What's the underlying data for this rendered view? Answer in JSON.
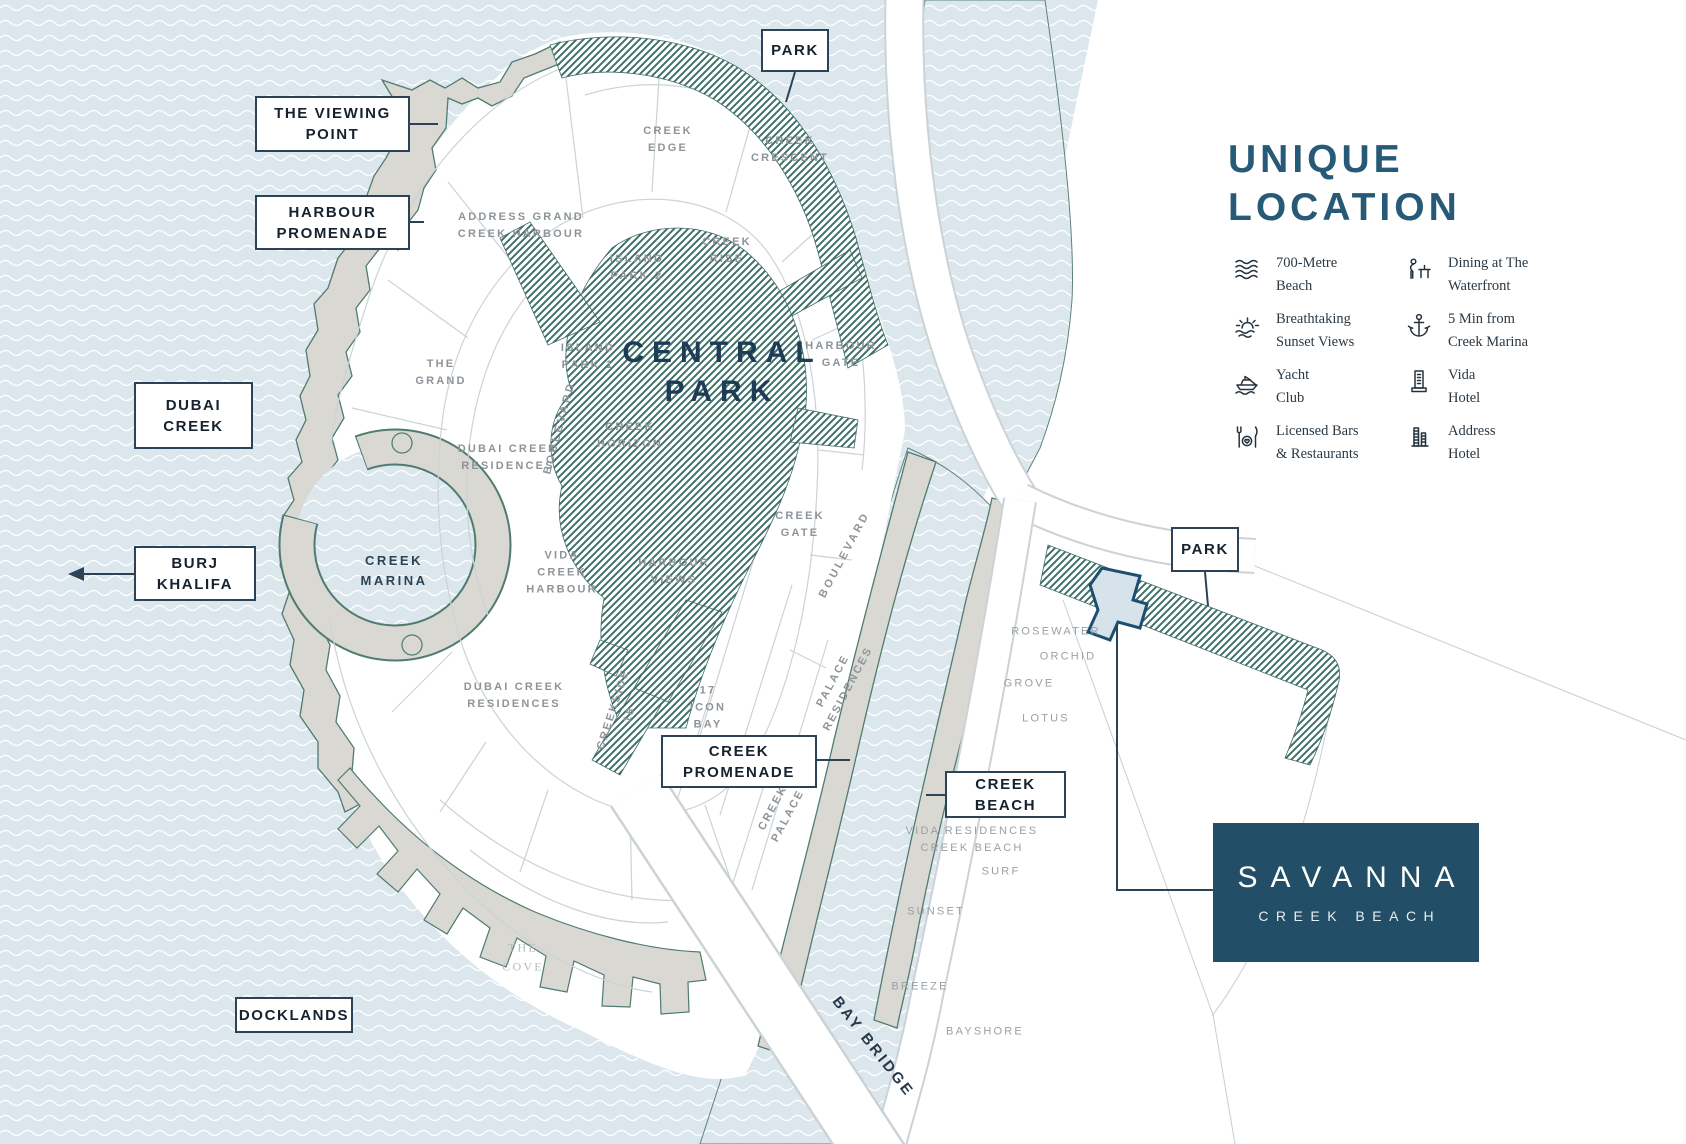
{
  "callouts": {
    "park_top": "PARK",
    "viewing_point": "THE VIEWING\nPOINT",
    "harbour_promenade": "HARBOUR\nPROMENADE",
    "dubai_creek": "DUBAI\nCREEK",
    "burj_khalifa": "BURJ\nKHALIFA",
    "docklands": "DOCKLANDS",
    "creek_promenade": "CREEK\nPROMENADE",
    "creek_beach": "CREEK\nBEACH",
    "park_right": "PARK"
  },
  "areas": {
    "central_park": "CENTRAL\nPARK",
    "creek_edge": "CREEK\nEDGE",
    "creek_crescent": "CREEK\nCRESCENT",
    "creek_rise": "CREEK\nRISE",
    "island_park_2": "ISLAND\nPARK 2",
    "island_park_1": "ISLAND\nPARK 1",
    "harbour_gate": "HARBOUR\nGATE",
    "the_grand": "THE\nGRAND",
    "address_grand_creek_harbour": "ADDRESS GRAND\nCREEK HARBOUR",
    "dubai_creek_residences_upper": "DUBAI CREEK\nRESIDENCES",
    "dubai_creek_residences_lower": "DUBAI CREEK\nRESIDENCES",
    "boulevard_left": "BOULEVARD",
    "boulevard_right": "BOULEVARD",
    "creek_horizon": "CREEK\nHORIZON",
    "vida_creek_harbour": "VIDA\nCREEK\nHARBOUR",
    "creek_marina": "CREEK\nMARINA",
    "harbour_views": "HARBOUR\nVIEWS",
    "creek_gate": "CREEK\nGATE",
    "creekside_18": "CREEKSIDE\n18",
    "icon_bay_17": "17\nICON\nBAY",
    "palace_residences": "PALACE\nRESIDENCES",
    "creek_palace": "CREEK\nPALACE",
    "rosewater": "ROSEWATER",
    "orchid": "ORCHID",
    "grove": "GROVE",
    "lotus": "LOTUS",
    "vida_residences_creek_beach": "VIDA RESIDENCES\nCREEK BEACH",
    "surf": "SURF",
    "sunset": "SUNSET",
    "breeze": "BREEZE",
    "bayshore": "BAYSHORE",
    "bay_bridge": "BAY BRIDGE",
    "the_cove": "THE\nCOVE"
  },
  "panel": {
    "title": "UNIQUE\nLOCATION",
    "features": [
      {
        "icon": "waves-icon",
        "label": "700-Metre\nBeach"
      },
      {
        "icon": "sunset-icon",
        "label": "Breathtaking\nSunset Views"
      },
      {
        "icon": "yacht-icon",
        "label": "Yacht\nClub"
      },
      {
        "icon": "bars-icon",
        "label": "Licensed Bars\n& Restaurants"
      },
      {
        "icon": "dining-icon",
        "label": "Dining at The\nWaterfront"
      },
      {
        "icon": "anchor-icon",
        "label": "5 Min from\nCreek Marina"
      },
      {
        "icon": "vida-hotel-icon",
        "label": "Vida\nHotel"
      },
      {
        "icon": "address-hotel-icon",
        "label": "Address\nHotel"
      }
    ]
  },
  "savanna": {
    "name": "SAVANNA",
    "subtitle": "CREEK BEACH"
  },
  "colors": {
    "water": "#dce7ed",
    "wave_line": "#ffffff",
    "land": "#ffffff",
    "shore": "#d9d8d3",
    "shore_edge": "#4f7b70",
    "hatch": "#3f6e67",
    "plot_line": "#ccd2d6",
    "label_gray": "#8d9499",
    "navy": "#1b2b3a",
    "heading_blue": "#275a76",
    "savanna_bg": "#224e67",
    "plot_fill": "#d6e3ea",
    "plot_stroke": "#1f4f6e",
    "leader": "#2b4257"
  }
}
